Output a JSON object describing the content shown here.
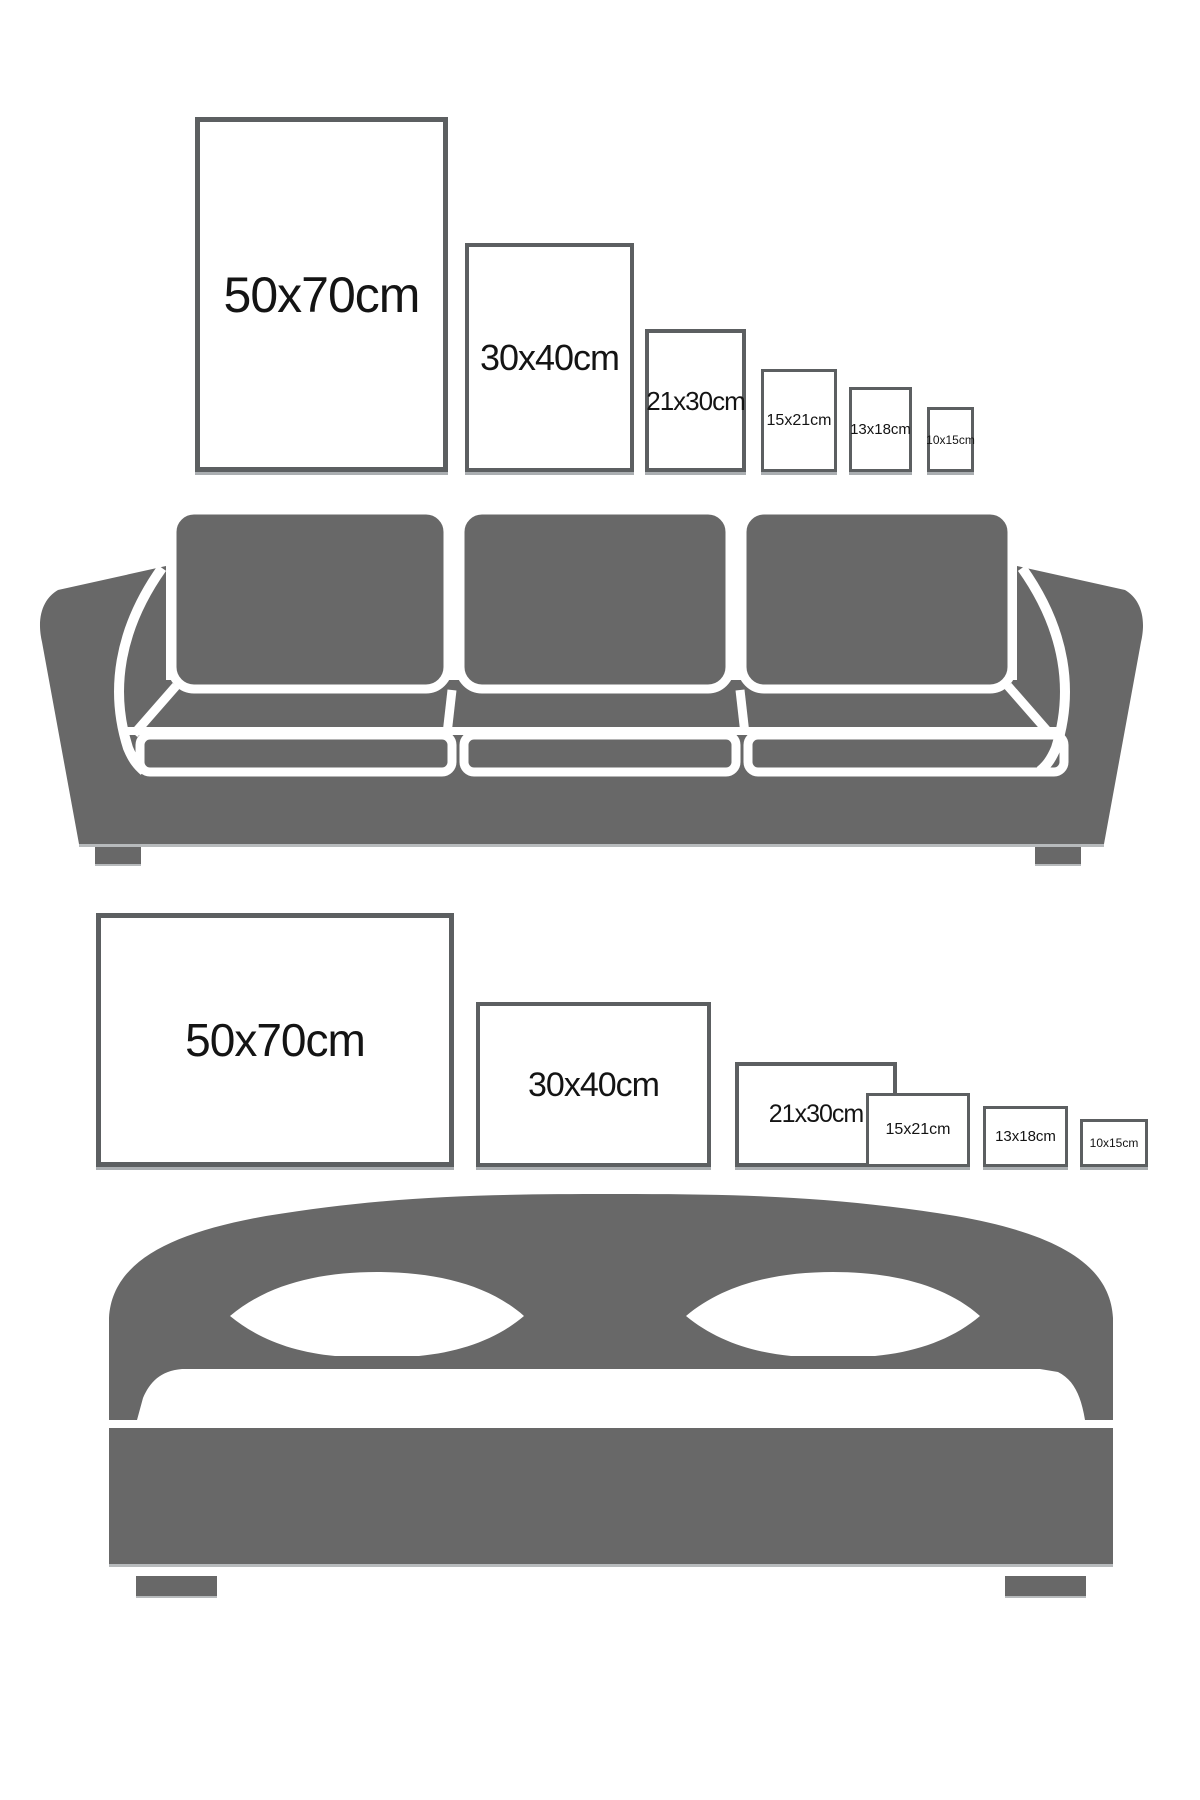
{
  "page": {
    "background": "#ffffff",
    "furniture_color": "#686868",
    "frame_border_color": "#5c5f61",
    "frame_shadow_color": "#aaaeb1",
    "label_color": "#141414"
  },
  "top_section": {
    "orientation": "portrait",
    "illustration": "sofa",
    "frames": [
      {
        "label": "50x70cm"
      },
      {
        "label": "30x40cm"
      },
      {
        "label": "21x30cm"
      },
      {
        "label": "15x21cm"
      },
      {
        "label": "13x18cm"
      },
      {
        "label": "10x15cm"
      }
    ]
  },
  "bottom_section": {
    "orientation": "landscape",
    "illustration": "bed",
    "frames": [
      {
        "label": "50x70cm"
      },
      {
        "label": "30x40cm"
      },
      {
        "label": "21x30cm"
      },
      {
        "label": "15x21cm"
      },
      {
        "label": "13x18cm"
      },
      {
        "label": "10x15cm"
      }
    ]
  }
}
